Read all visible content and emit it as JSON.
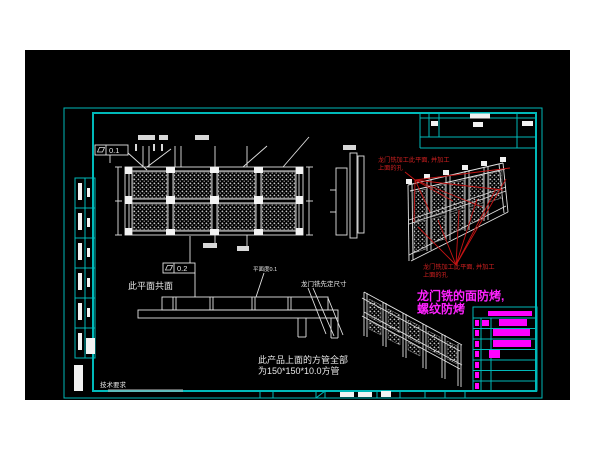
{
  "colors": {
    "page_background": "#ffffff",
    "canvas_background": "#000000",
    "frame_cyan": "#00b9b9",
    "linework_white": "#e2e2e2",
    "annotation_red": "#d02020",
    "highlight_magenta": "#ff00ff"
  },
  "tolerances": {
    "flatness_top": "0.1",
    "flatness_bottom": "0.2"
  },
  "notes": {
    "red_note_top": {
      "line1": "龙门铣加工此平面, 并加工",
      "line2": "上面的孔"
    },
    "red_note_bottom": {
      "line1": "龙门铣加工此平面, 并加工",
      "line2": "上面的孔"
    },
    "magenta_note": {
      "line1": "龙门铣的面防烤,",
      "line2": "螺纹防烤"
    },
    "coplanar_note": "此平面共面",
    "platform_flatness_note": "平面度0.1",
    "gantry_note": "龙门铣先定尺寸",
    "product_note": {
      "line1": "此产品上面的方管全部",
      "line2": "为150*150*10.0方管"
    },
    "tech_requirements": "技术要求"
  },
  "parts_table": {
    "total_rows": 7,
    "rows_with_long_entries": 4,
    "entry_color": "#ff00ff"
  }
}
